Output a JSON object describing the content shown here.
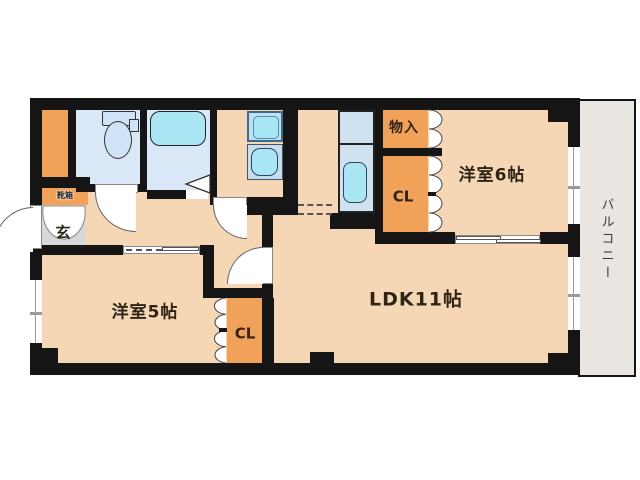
{
  "floor_plan": {
    "rooms": {
      "ldk": {
        "label": "LDK11帖"
      },
      "western_room_6": {
        "label": "洋室6帖"
      },
      "western_room_5": {
        "label": "洋室5帖"
      },
      "balcony": {
        "label": "バルコニー"
      },
      "entrance": {
        "label": "玄"
      },
      "shoe_cabinet": {
        "label": "靴箱"
      },
      "storage": {
        "label": "物入"
      },
      "closet_east": {
        "label": "CL"
      },
      "closet_west": {
        "label": "CL"
      }
    },
    "colors": {
      "wall": "#151515",
      "floor_peach": "#f5d7b6",
      "closet_orange": "#f2a158",
      "wet_room_blue": "#d9e7f6",
      "fixture_cyan": "#a9e6f3",
      "counter_blue": "#cfe2f2",
      "entrance_gray": "#d8d8d8",
      "balcony_gray": "#e9e5e0",
      "text": "#2e2416"
    }
  }
}
